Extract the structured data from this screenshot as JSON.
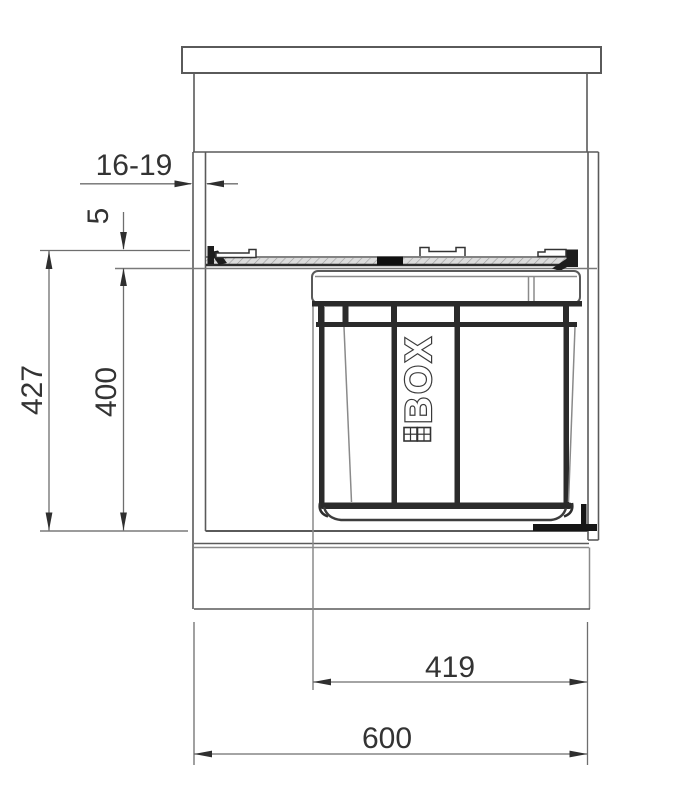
{
  "drawing": {
    "bin_label": "BOX",
    "dimensions": {
      "side_panel_thickness": "16-19",
      "top_clearance": "5",
      "niche_height": "427",
      "system_height": "400",
      "system_width": "419",
      "cabinet_width": "600"
    },
    "colors": {
      "background": "#ffffff",
      "outline": "#4f4f4f",
      "frame_dark": "#2b2b2b",
      "dimension_line": "#6e6e6e",
      "dimension_text": "#333333",
      "rail_hatch": "#dcdcdc"
    }
  }
}
